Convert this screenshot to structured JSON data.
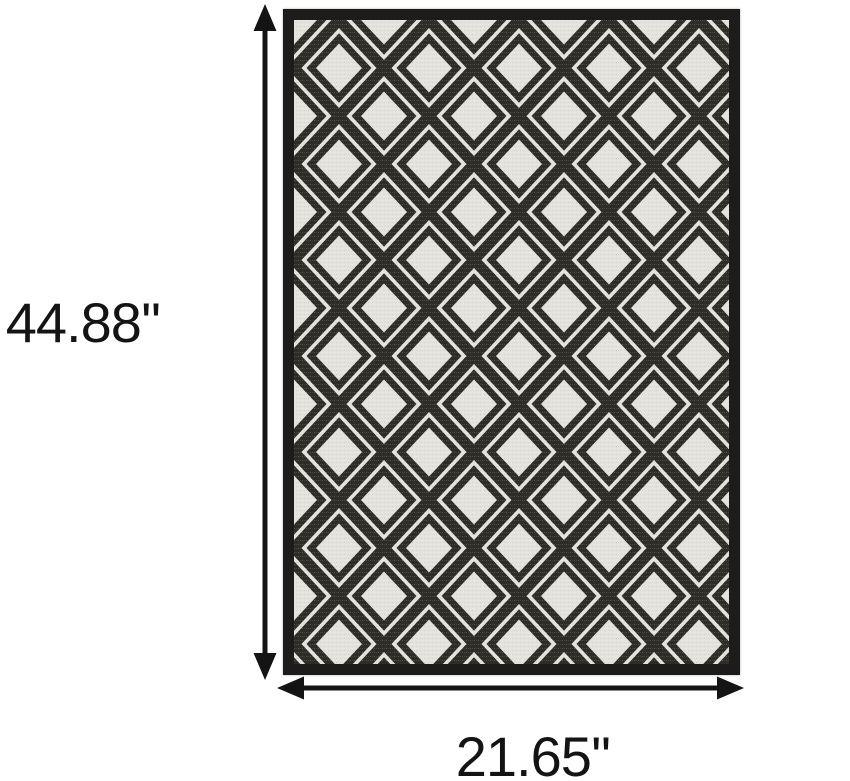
{
  "product_diagram": {
    "type": "rug-dimension-diagram",
    "height_label": "44.88''",
    "width_label": "21.65''",
    "rug": {
      "pattern": "diamond-lattice",
      "border_color": "#1e1c1b",
      "field_color": "#e5e3de",
      "pattern_color": "#2f2d27"
    },
    "annotation_color": "#141414",
    "background_color": "#ffffff"
  }
}
